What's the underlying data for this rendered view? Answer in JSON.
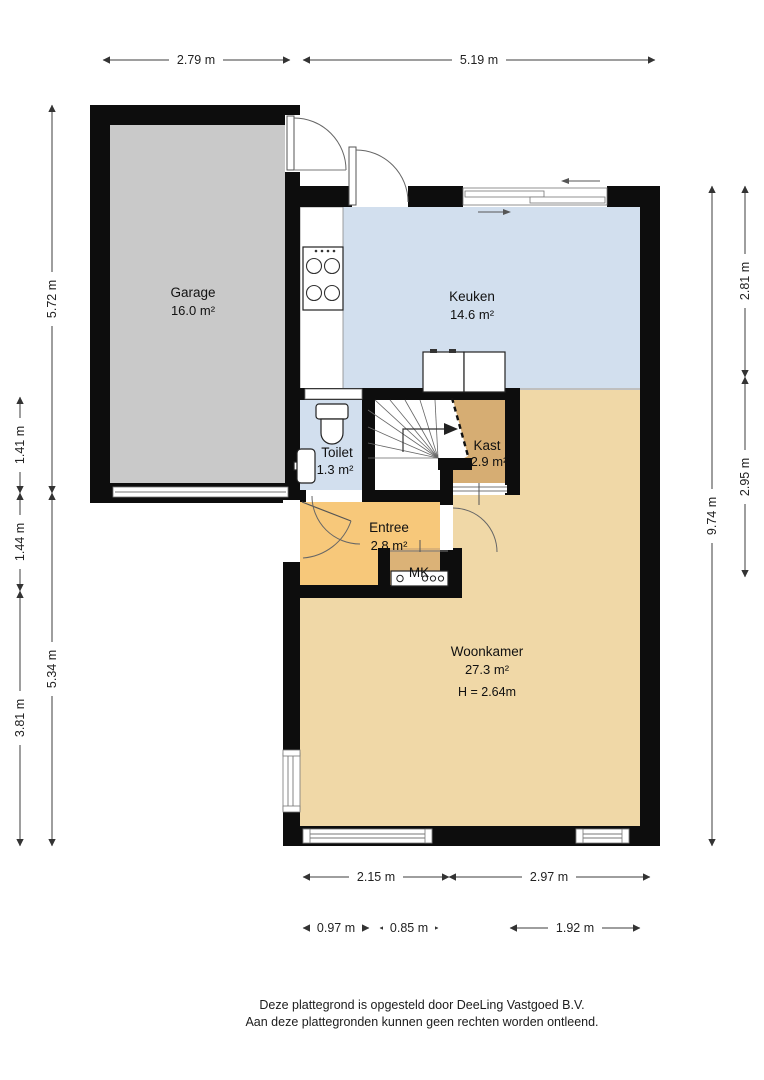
{
  "title": "Plattegrond begane grond",
  "rooms": {
    "garage": {
      "label": "Garage",
      "area": "16.0 m²"
    },
    "keuken": {
      "label": "Keuken",
      "area": "14.6 m²"
    },
    "toilet": {
      "label": "Toilet",
      "area": "1.3 m²"
    },
    "kast": {
      "label": "Kast",
      "area": "2.9 m²"
    },
    "entree": {
      "label": "Entree",
      "area": "2.8 m²"
    },
    "woonkamer": {
      "label": "Woonkamer",
      "area": "27.3 m²",
      "height": "H = 2.64m"
    },
    "mk": {
      "label": "MK"
    }
  },
  "dims": {
    "top_garage": "2.79 m",
    "top_house": "5.19 m",
    "left_garage": "5.72 m",
    "left_toilet": "1.41 m",
    "left_entree": "1.44 m",
    "left_woonkamer": "3.81 m",
    "left_lower_total": "5.34 m",
    "right_keuken": "2.81 m",
    "right_mid": "2.95 m",
    "right_total": "9.74 m",
    "bottom_left": "2.15 m",
    "bottom_right": "2.97 m",
    "bottom_win1": "0.97 m",
    "bottom_win2": "0.85 m",
    "bottom_win3": "1.92 m"
  },
  "footer": {
    "line1": "Deze plattegrond is opgesteld door DeeLing Vastgoed B.V.",
    "line2": "Aan deze plattegronden kunnen geen rechten worden ontleend."
  },
  "colors": {
    "wall": "#0d0d0d",
    "garage_gray": "#c9c9c9",
    "kitchen_blue": "#d2dfee",
    "living_tan": "#f0d8a7",
    "entree_orange": "#f7c87a",
    "kast_tan": "#d6ad73",
    "mk_tan": "#dbb277"
  }
}
